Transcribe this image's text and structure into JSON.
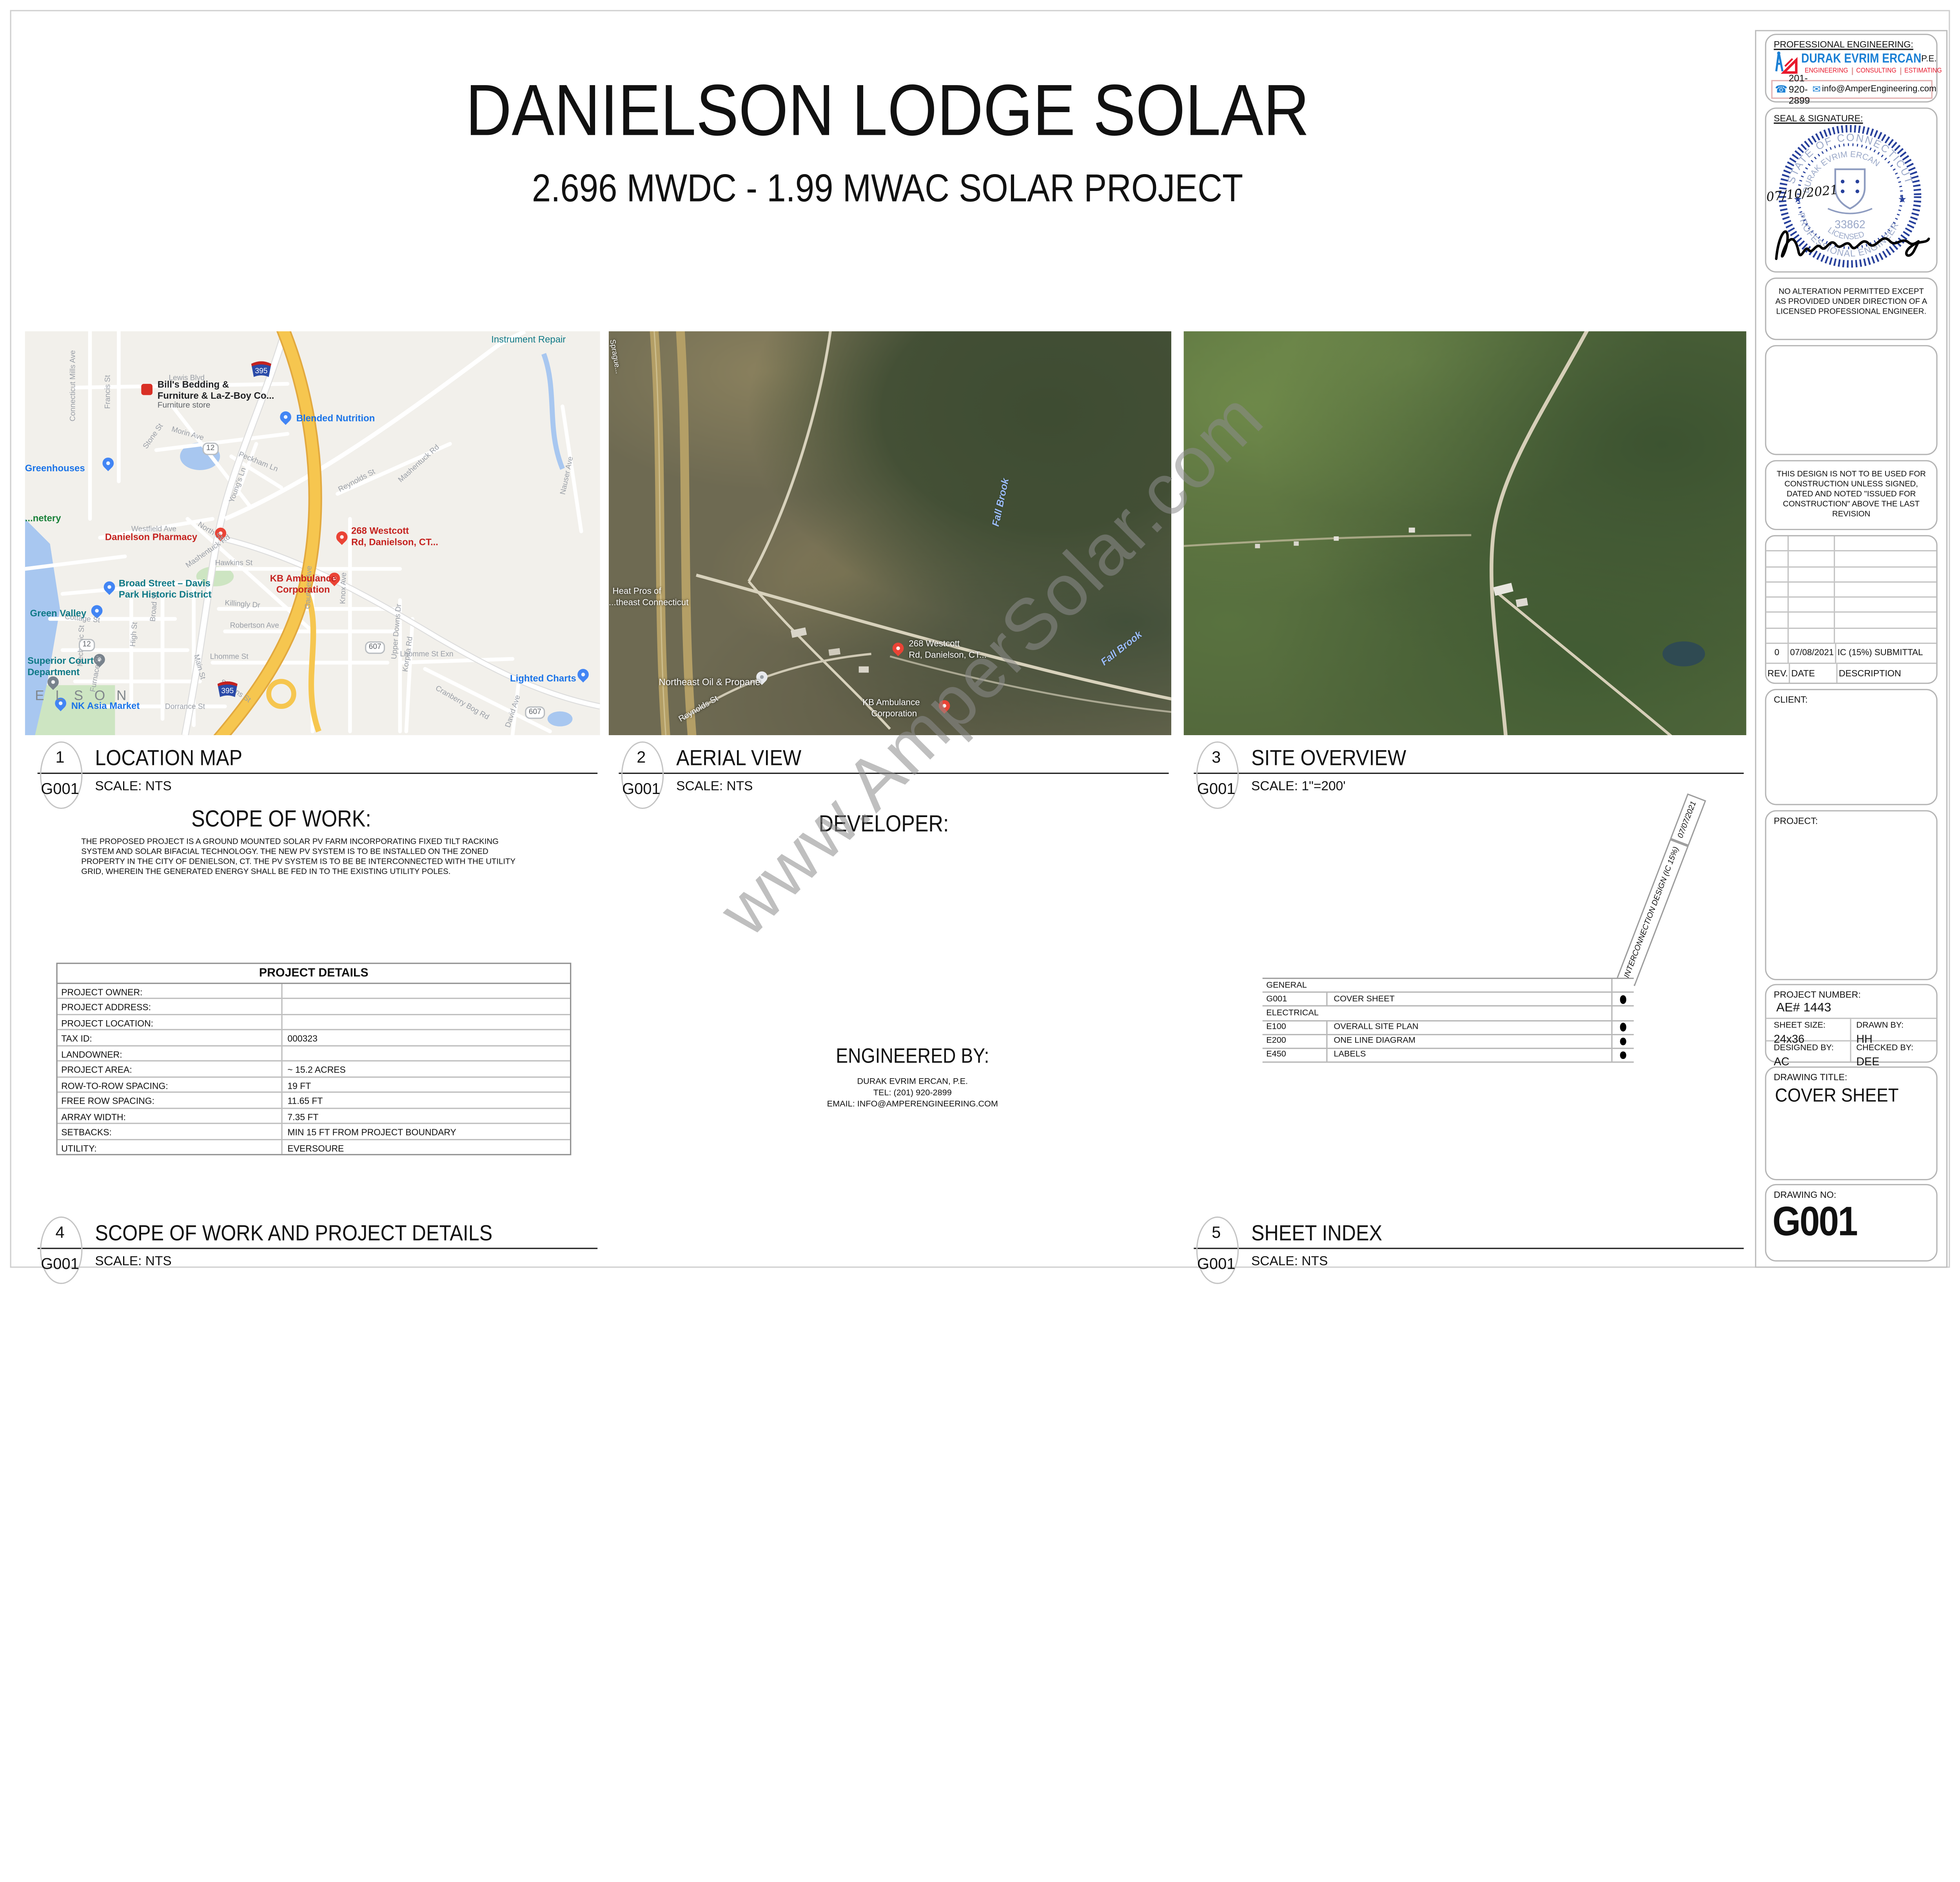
{
  "sheet": {
    "title": "DANIELSON LODGE SOLAR",
    "subtitle": "2.696 MWDC - 1.99 MWAC SOLAR PROJECT",
    "watermark": "www.AmperSolar.com"
  },
  "icons": {
    "phone": "☎",
    "email": "✉"
  },
  "panels": {
    "p1": {
      "num": "1",
      "code": "G001",
      "title": "LOCATION MAP",
      "scale": "SCALE:  NTS"
    },
    "p2": {
      "num": "2",
      "code": "G001",
      "title": "AERIAL VIEW",
      "scale": "SCALE:  NTS"
    },
    "p3": {
      "num": "3",
      "code": "G001",
      "title": "SITE OVERVIEW",
      "scale": "SCALE:  1\"=200'"
    },
    "p4": {
      "num": "4",
      "code": "G001",
      "title": "SCOPE OF WORK AND PROJECT DETAILS",
      "scale": "SCALE:  NTS"
    },
    "p5": {
      "num": "5",
      "code": "G001",
      "title": "SHEET INDEX",
      "scale": "SCALE:  NTS"
    }
  },
  "scope": {
    "heading": "SCOPE OF WORK:",
    "body": "THE PROPOSED PROJECT IS A GROUND MOUNTED SOLAR PV FARM INCORPORATING FIXED TILT RACKING SYSTEM AND SOLAR BIFACIAL TECHNOLOGY. THE NEW PV SYSTEM IS TO BE INSTALLED ON THE ZONED PROPERTY IN THE CITY OF DENIELSON, CT. THE PV SYSTEM IS TO BE BE INTERCONNECTED WITH THE UTILITY GRID, WHEREIN THE GENERATED ENERGY SHALL BE FED IN TO THE EXISTING UTILITY POLES."
  },
  "developer": {
    "heading": "DEVELOPER:"
  },
  "engineered_by": {
    "heading": "ENGINEERED BY:",
    "name": "DURAK EVRIM ERCAN, P.E.",
    "tel": "TEL: (201) 920-2899",
    "email": "EMAIL: INFO@AMPERENGINEERING.COM"
  },
  "project_details": {
    "title": "PROJECT DETAILS",
    "rows": [
      {
        "label": "PROJECT OWNER:",
        "value": ""
      },
      {
        "label": "PROJECT ADDRESS:",
        "value": ""
      },
      {
        "label": "PROJECT LOCATION:",
        "value": ""
      },
      {
        "label": "TAX ID:",
        "value": "000323"
      },
      {
        "label": "LANDOWNER:",
        "value": ""
      },
      {
        "label": "PROJECT AREA:",
        "value": "~ 15.2 ACRES"
      },
      {
        "label": "ROW-TO-ROW SPACING:",
        "value": "19 FT"
      },
      {
        "label": "FREE ROW SPACING:",
        "value": "11.65 FT"
      },
      {
        "label": "ARRAY WIDTH:",
        "value": "7.35 FT"
      },
      {
        "label": "SETBACKS:",
        "value": "MIN 15 FT FROM PROJECT BOUNDARY"
      },
      {
        "label": "UTILITY:",
        "value": "EVERSOURE"
      }
    ]
  },
  "sheet_index": {
    "diag_label": "INTERCONNECTION DESIGN (IC 15%)",
    "diag_date": "07/07/2021",
    "rows": [
      {
        "code": "GENERAL",
        "name": ""
      },
      {
        "code": "G001",
        "name": "COVER SHEET"
      },
      {
        "code": "ELECTRICAL",
        "name": ""
      },
      {
        "code": "E100",
        "name": "OVERALL SITE PLAN"
      },
      {
        "code": "E200",
        "name": "ONE LINE DIAGRAM"
      },
      {
        "code": "E450",
        "name": "LABELS"
      }
    ]
  },
  "titleblock": {
    "prof_label": "PROFESSIONAL ENGINEERING:",
    "firm": "DURAK EVRIM ERCAN",
    "pe": "P.E.",
    "services": [
      "ENGINEERING",
      "CONSULTING",
      "ESTIMATING"
    ],
    "phone": "201-920-2899",
    "email": "info@AmperEngineering.com",
    "seal_label": "SEAL & SIGNATURE:",
    "seal": {
      "state": "STATE OF CONNECTICUT",
      "name": "DURAK EVRIM ERCAN",
      "number": "33862",
      "licensed": "LICENSED",
      "profession": "PROFESSIONAL ENGINEER",
      "date": "07/10/2021"
    },
    "note_alteration": "NO ALTERATION PERMITTED EXCEPT AS PROVIDED UNDER DIRECTION OF A LICENSED PROFESSIONAL ENGINEER.",
    "note_construction": "THIS DESIGN IS NOT TO BE USED FOR CONSTRUCTION UNLESS SIGNED, DATED AND NOTED \"ISSUED FOR CONSTRUCTION\" ABOVE THE LAST REVISION",
    "revisions": {
      "headers": {
        "rev": "REV.",
        "date": "DATE",
        "desc": "DESCRIPTION"
      },
      "rows": [
        {
          "rev": "0",
          "date": "07/08/2021",
          "desc": "IC (15%) SUBMITTAL"
        }
      ]
    },
    "client_label": "CLIENT:",
    "project_label": "PROJECT:",
    "project_number_label": "PROJECT NUMBER:",
    "project_number": "AE# 1443",
    "sheet_size_label": "SHEET SIZE:",
    "sheet_size": "24x36",
    "drawn_label": "DRAWN BY:",
    "drawn": "HH",
    "designed_label": "DESIGNED BY:",
    "designed": "AC",
    "checked_label": "CHECKED BY:",
    "checked": "DEE",
    "drawing_title_label": "DRAWING TITLE:",
    "drawing_title": "COVER SHEET",
    "drawing_no_label": "DRAWING NO:",
    "drawing_no": "G001"
  },
  "location_map": {
    "labels": {
      "instrument_repair": "Instrument Repair",
      "bills1": "Bill's Bedding &",
      "bills2": "Furniture & La-Z-Boy Co...",
      "bills3": "Furniture store",
      "greenhouses": "Greenhouses",
      "cemetery": "...netery",
      "blended": "Blended Nutrition",
      "pharmacy": "Danielson Pharmacy",
      "westcott1": "268 Westcott",
      "westcott2": "Rd, Danielson, CT...",
      "historic1": "Broad Street – Davis",
      "historic2": "Park Historic District",
      "green_valley": "Green Valley",
      "superior1": "Superior Court",
      "superior2": "Department",
      "kb1": "KB Ambulance",
      "kb2": "Corporation",
      "city": "E L S O N",
      "nk": "NK Asia Market",
      "lighted": "Lighted Charts",
      "r12": "12",
      "r607": "607",
      "i395": "395"
    },
    "streets": [
      "Connecticut Mills Ave",
      "Francis St",
      "Lewis Blvd",
      "Morin Ave",
      "Stone St",
      "North St",
      "Westfield Ave",
      "Main St",
      "Stearns St",
      "Mechanic St",
      "Broad St",
      "High St",
      "Cottage St",
      "Furnace St",
      "Hawkins St",
      "Killingly Dr",
      "Robertson Ave",
      "Lhomme St",
      "Knox Ave",
      "Gauthier Ave",
      "Reynolds St",
      "Upper Downs Dr",
      "Mashentuck Rd",
      "Korpita Rd",
      "Cranberry Bog Rd",
      "David Ave",
      "Nauser Ave",
      "Young's Ln",
      "Peckham Ln",
      "Dorrance St",
      "Lhomme St Exn"
    ]
  },
  "aerial_view": {
    "labels": {
      "sprague": "Sprague...",
      "heat1": "Heat Pros of",
      "heat2": "...theast Connecticut",
      "oil": "Northeast Oil & Propane",
      "westcott1": "268 Westcott",
      "westcott2": "Rd, Danielson, CT...",
      "kb1": "KB Ambulance",
      "kb2": "Corporation",
      "fall1": "Fall Brook",
      "fall2": "Fall Brook",
      "reynolds": "Reynolds St"
    }
  }
}
